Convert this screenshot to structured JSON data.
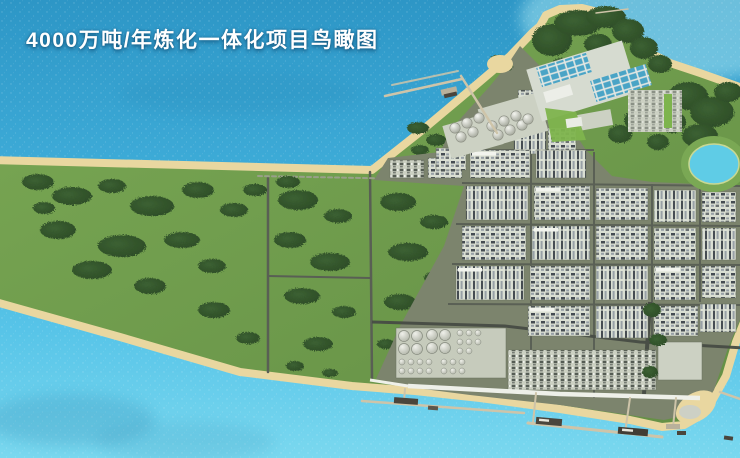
{
  "title": {
    "text": "4000万吨/年炼化一体化项目鸟瞰图"
  },
  "scene": {
    "type": "aerial-rendering",
    "features": [
      "预留绿地",
      "炼化装置区",
      "储罐区",
      "球罐区",
      "装卸区",
      "海运码头栈桥",
      "防波堤",
      "污水处理设施",
      "山体绿化",
      "景观湖",
      "停车场",
      "海滩岸线"
    ],
    "blocks": [
      [
        390,
        160,
        34,
        18,
        "u",
        0
      ],
      [
        428,
        158,
        34,
        20,
        "a",
        0
      ],
      [
        518,
        90,
        26,
        28,
        "a",
        0
      ],
      [
        514,
        122,
        32,
        32,
        "b",
        0
      ],
      [
        548,
        128,
        28,
        30,
        "a",
        0
      ],
      [
        436,
        148,
        30,
        22,
        "a",
        0
      ],
      [
        470,
        150,
        60,
        28,
        "a",
        1
      ],
      [
        536,
        150,
        50,
        28,
        "b",
        0
      ],
      [
        466,
        186,
        62,
        34,
        "b",
        0
      ],
      [
        534,
        186,
        56,
        34,
        "a",
        1
      ],
      [
        596,
        188,
        52,
        32,
        "a",
        0
      ],
      [
        654,
        190,
        42,
        32,
        "b",
        0
      ],
      [
        702,
        192,
        34,
        30,
        "a",
        0
      ],
      [
        462,
        226,
        64,
        34,
        "a",
        0
      ],
      [
        532,
        226,
        58,
        34,
        "b",
        1
      ],
      [
        596,
        226,
        52,
        34,
        "a",
        0
      ],
      [
        654,
        228,
        42,
        32,
        "a",
        0
      ],
      [
        702,
        228,
        34,
        32,
        "b",
        0
      ],
      [
        456,
        266,
        68,
        34,
        "b",
        1
      ],
      [
        530,
        266,
        60,
        34,
        "a",
        0
      ],
      [
        596,
        266,
        52,
        34,
        "b",
        0
      ],
      [
        654,
        266,
        42,
        34,
        "a",
        1
      ],
      [
        702,
        266,
        34,
        32,
        "a",
        0
      ],
      [
        528,
        306,
        62,
        30,
        "a",
        1
      ],
      [
        596,
        306,
        52,
        32,
        "b",
        0
      ],
      [
        654,
        306,
        44,
        30,
        "a",
        0
      ],
      [
        700,
        304,
        36,
        28,
        "b",
        0
      ],
      [
        486,
        352,
        18,
        22,
        "p",
        0
      ],
      [
        508,
        350,
        148,
        40,
        "u",
        0
      ],
      [
        658,
        342,
        44,
        38,
        "p",
        0
      ]
    ],
    "wedge_trees": [
      [
        38,
        182,
        16,
        8
      ],
      [
        72,
        196,
        20,
        9
      ],
      [
        112,
        186,
        14,
        7
      ],
      [
        152,
        206,
        22,
        10
      ],
      [
        198,
        190,
        16,
        8
      ],
      [
        234,
        210,
        14,
        7
      ],
      [
        58,
        230,
        18,
        9
      ],
      [
        122,
        246,
        24,
        11
      ],
      [
        182,
        240,
        18,
        8
      ],
      [
        92,
        270,
        20,
        9
      ],
      [
        150,
        286,
        16,
        8
      ],
      [
        44,
        208,
        11,
        6
      ],
      [
        212,
        266,
        14,
        7
      ],
      [
        214,
        310,
        16,
        8
      ],
      [
        248,
        338,
        12,
        6
      ],
      [
        255,
        190,
        12,
        6
      ],
      [
        298,
        200,
        20,
        10
      ],
      [
        338,
        216,
        14,
        7
      ],
      [
        290,
        240,
        16,
        8
      ],
      [
        330,
        262,
        20,
        9
      ],
      [
        302,
        296,
        18,
        8
      ],
      [
        344,
        312,
        12,
        6
      ],
      [
        318,
        344,
        15,
        7
      ],
      [
        288,
        182,
        12,
        6
      ],
      [
        398,
        202,
        18,
        9
      ],
      [
        434,
        222,
        14,
        7
      ],
      [
        408,
        252,
        20,
        9
      ],
      [
        438,
        278,
        14,
        7
      ],
      [
        400,
        302,
        16,
        8
      ],
      [
        430,
        312,
        12,
        6
      ],
      [
        386,
        344,
        9,
        5
      ],
      [
        295,
        366,
        9,
        5
      ],
      [
        330,
        373,
        8,
        4
      ],
      [
        418,
        128,
        11,
        6
      ],
      [
        436,
        140,
        10,
        6
      ],
      [
        420,
        150,
        9,
        5
      ]
    ],
    "hill_trees": [
      [
        552,
        40,
        20,
        16
      ],
      [
        578,
        23,
        24,
        13
      ],
      [
        606,
        17,
        20,
        11
      ],
      [
        628,
        31,
        16,
        12
      ],
      [
        644,
        48,
        14,
        11
      ],
      [
        660,
        64,
        12,
        9
      ],
      [
        562,
        68,
        12,
        10
      ],
      [
        598,
        44,
        14,
        10
      ],
      [
        688,
        96,
        20,
        14
      ],
      [
        712,
        112,
        22,
        15
      ],
      [
        700,
        136,
        18,
        12
      ],
      [
        728,
        92,
        14,
        10
      ],
      [
        672,
        122,
        14,
        11
      ],
      [
        640,
        120,
        16,
        11
      ],
      [
        620,
        134,
        12,
        9
      ],
      [
        658,
        142,
        11,
        8
      ],
      [
        652,
        310,
        9,
        7
      ],
      [
        658,
        340,
        9,
        6
      ],
      [
        650,
        372,
        8,
        6
      ],
      [
        498,
        61,
        9,
        6
      ],
      [
        505,
        66,
        8,
        5
      ]
    ],
    "tanks_large": [
      [
        404,
        336
      ],
      [
        417,
        336
      ],
      [
        404,
        349
      ],
      [
        417,
        349
      ],
      [
        432,
        335
      ],
      [
        445,
        335
      ],
      [
        432,
        348
      ],
      [
        445,
        348
      ]
    ],
    "tanks_small": [
      [
        460,
        333
      ],
      [
        469,
        333
      ],
      [
        478,
        333
      ],
      [
        460,
        342
      ],
      [
        469,
        342
      ],
      [
        478,
        342
      ],
      [
        460,
        351
      ],
      [
        469,
        351
      ],
      [
        402,
        362
      ],
      [
        411,
        362
      ],
      [
        420,
        362
      ],
      [
        429,
        362
      ],
      [
        402,
        371
      ],
      [
        411,
        371
      ],
      [
        420,
        371
      ],
      [
        429,
        371
      ],
      [
        444,
        362
      ],
      [
        453,
        362
      ],
      [
        462,
        362
      ],
      [
        444,
        371
      ],
      [
        453,
        371
      ],
      [
        462,
        371
      ]
    ],
    "tank_large_radius": 5.5,
    "tank_small_radius": 3,
    "spheres": [
      [
        455,
        128
      ],
      [
        467,
        123
      ],
      [
        479,
        118
      ],
      [
        461,
        137
      ],
      [
        473,
        132
      ],
      [
        492,
        126
      ],
      [
        504,
        121
      ],
      [
        516,
        116
      ],
      [
        498,
        135
      ],
      [
        510,
        130
      ],
      [
        522,
        125
      ],
      [
        528,
        119
      ]
    ],
    "sphere_radius": 5.2
  },
  "colors": {
    "water_deep": "#2d96c6",
    "water_mid": "#3fadd9",
    "water_shallow": "#57c4e8",
    "water_light": "#7ad8ef",
    "water_glint": "#abe8f3",
    "sand": "#e9d7a0",
    "grass_light": "#7aa854",
    "grass_dark": "#648f45",
    "forest_mid": "#3c6132",
    "forest_dark": "#2b4a26",
    "platform": "#7c846d",
    "road": "#595f54",
    "road_dark": "#474c44",
    "block_light": "#dadfd3",
    "block_mid": "#ccd1c3",
    "equip_dark": "#454c52",
    "equip_steel": "#97a0a6",
    "quay": "#eef0e9",
    "pier": "#cec4a9",
    "ship": "#4a453c",
    "pond": "#5fcce6",
    "facility_blue": "#4aa4c6",
    "lawn": "#7eb44d",
    "tank_light": "#eff0ea",
    "tank_dark": "#b0b4a7",
    "shadow": "#10608e",
    "title_color": "#ffffff"
  }
}
